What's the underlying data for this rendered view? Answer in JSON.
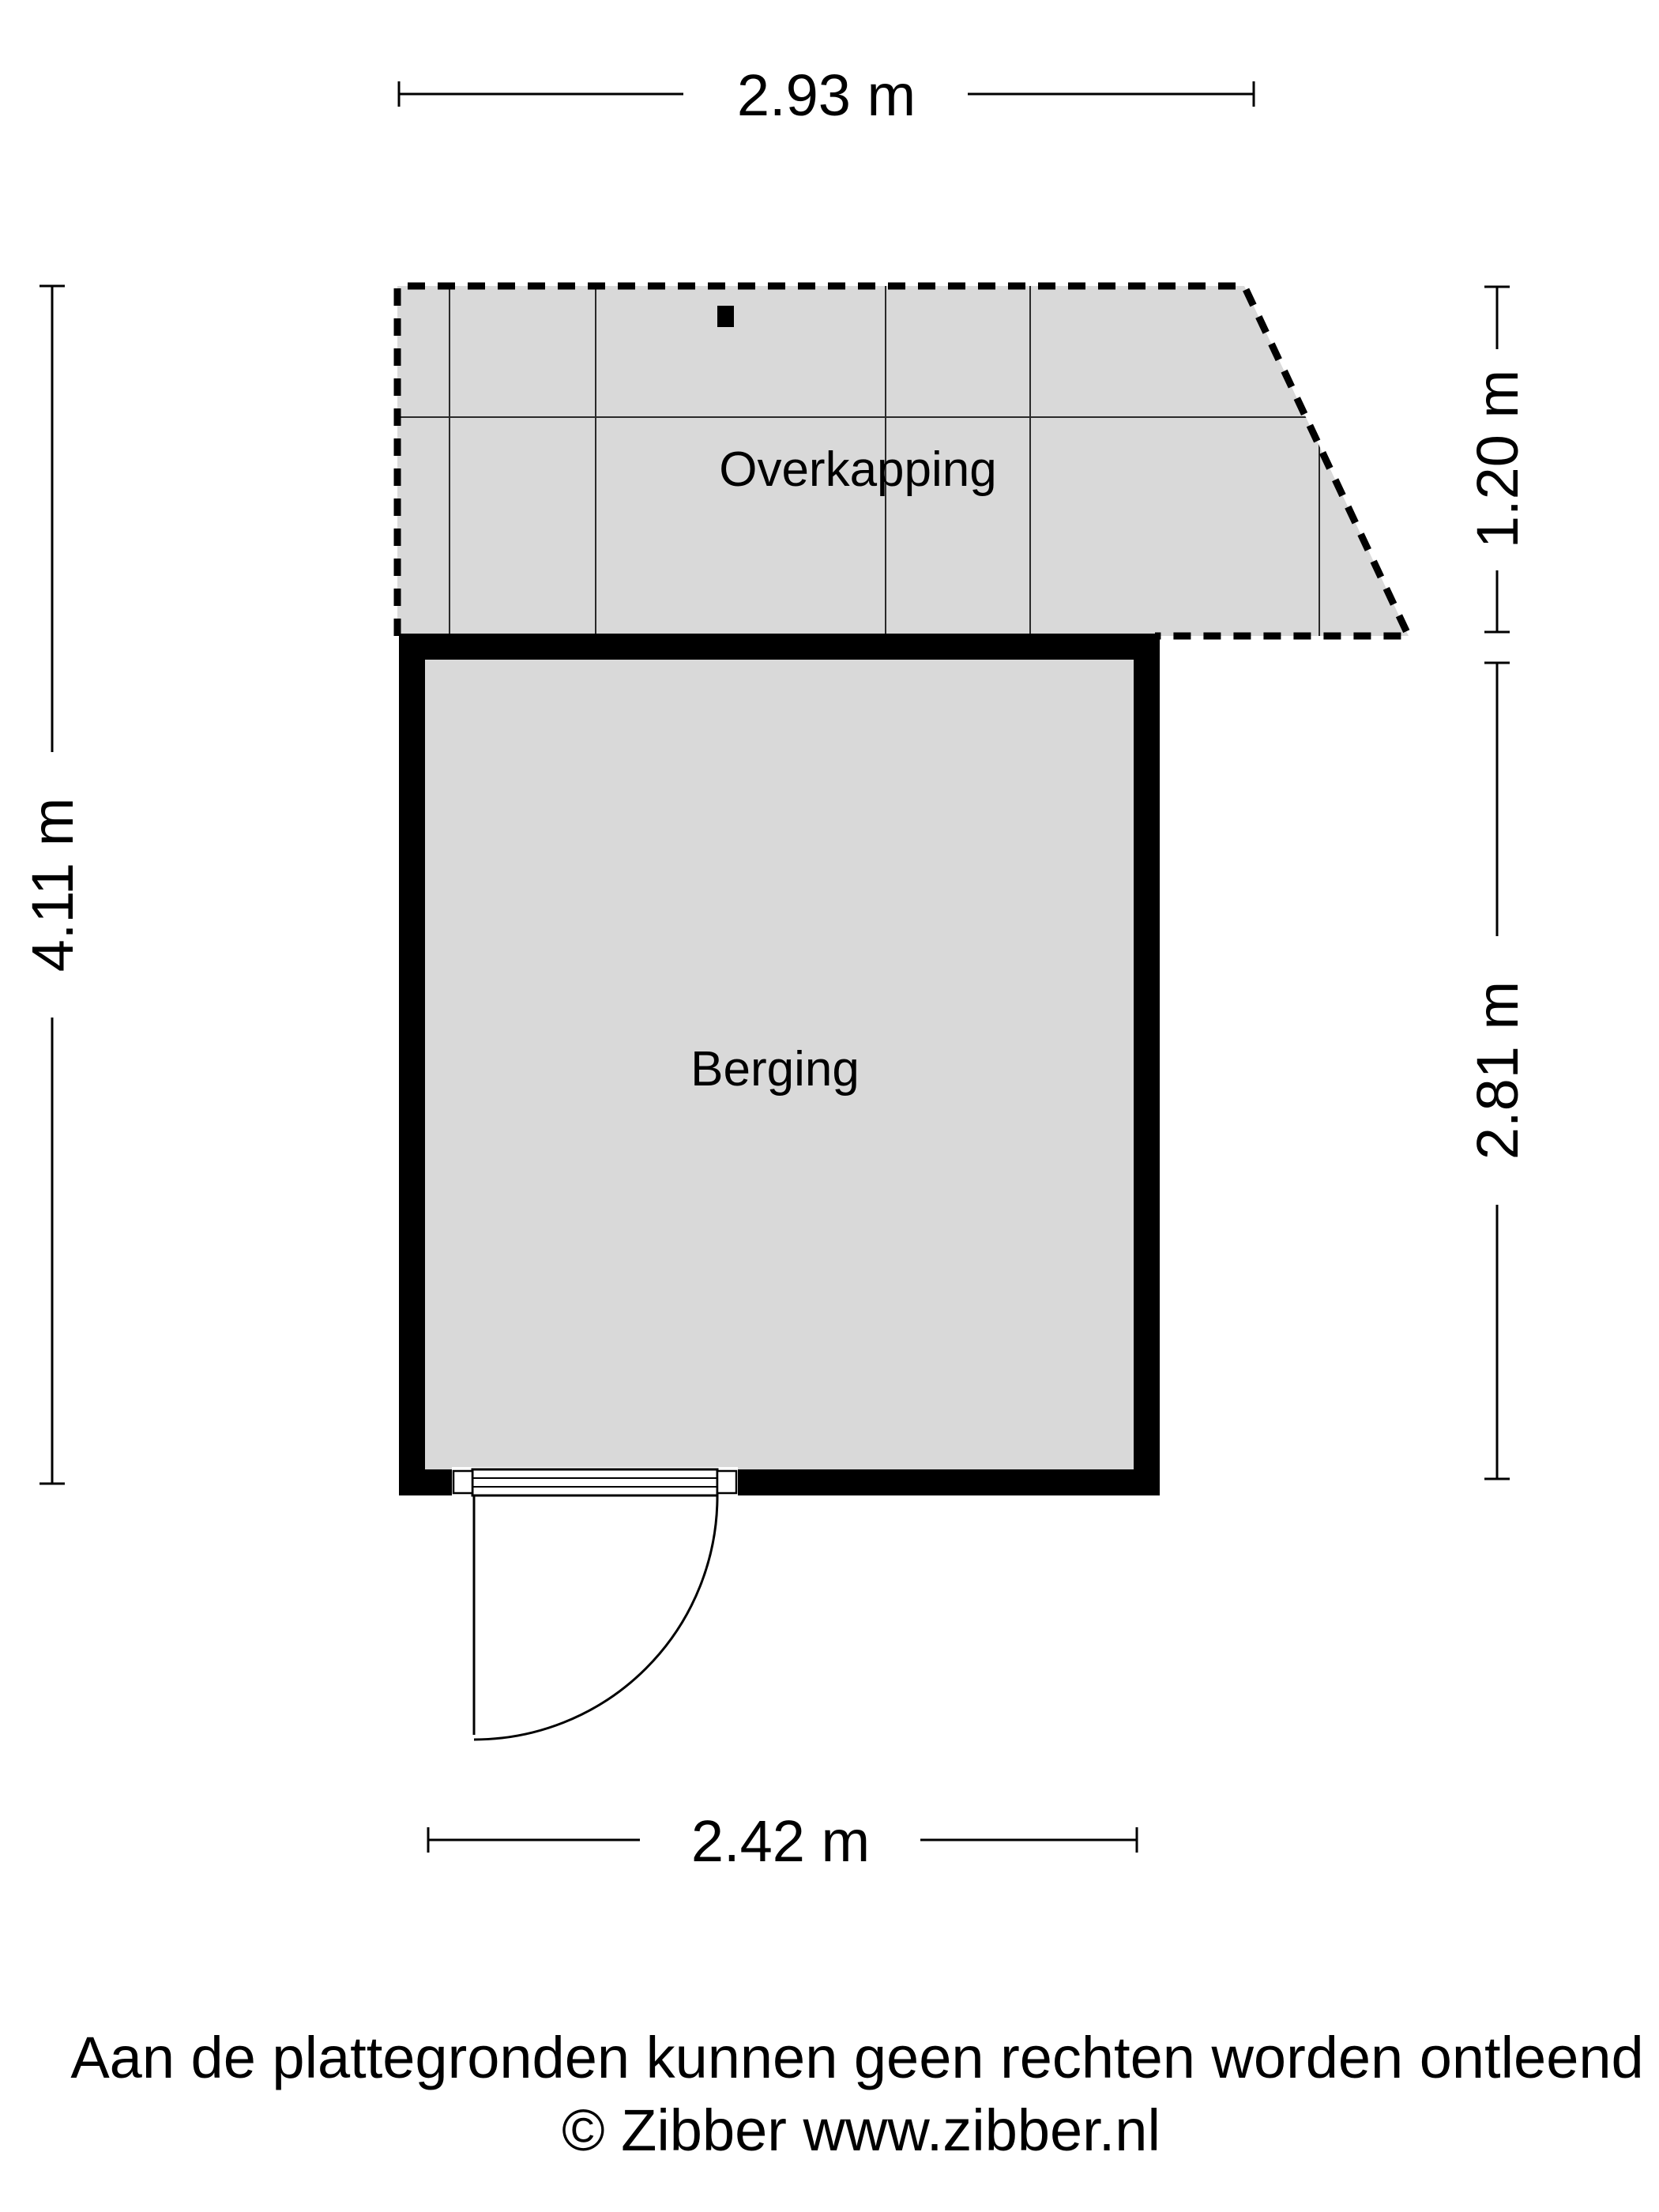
{
  "floorplan": {
    "overkapping": {
      "label": "Overkapping"
    },
    "berging": {
      "label": "Berging"
    }
  },
  "dimensions": {
    "top": {
      "label": "2.93 m"
    },
    "left": {
      "label": "4.11 m"
    },
    "right_top": {
      "label": "1.20 m"
    },
    "right_bottom": {
      "label": "2.81 m"
    },
    "bottom": {
      "label": "2.42 m"
    }
  },
  "footer": {
    "disclaimer": "Aan de plattegronden kunnen geen rechten worden ontleend",
    "copyright": "© Zibber www.zibber.nl"
  },
  "colors": {
    "area_fill": "#d9d9d9",
    "wall": "#000000",
    "line": "#2a2a2a"
  }
}
